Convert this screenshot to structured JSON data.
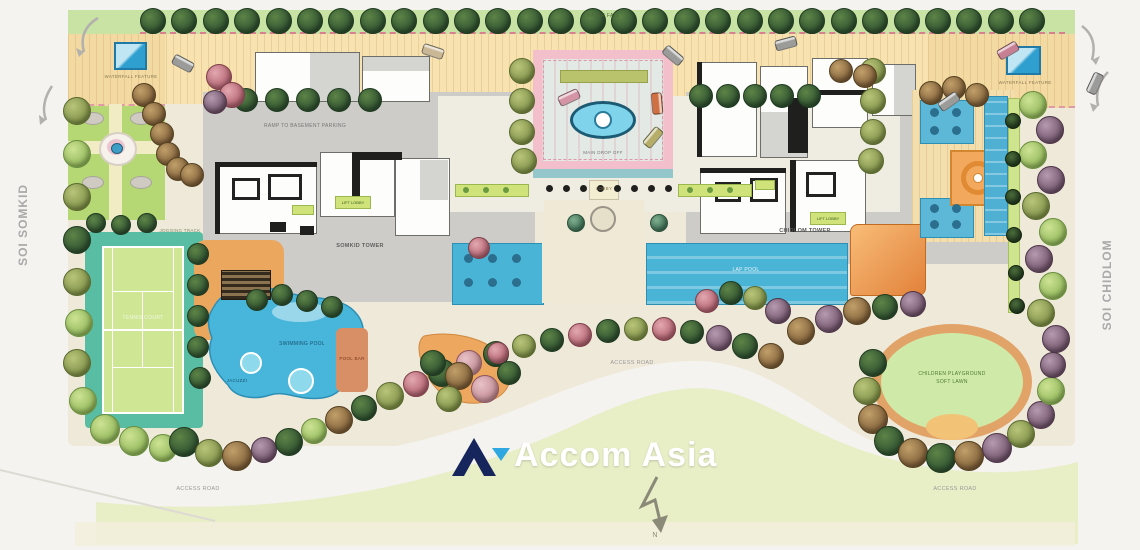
{
  "watermark": {
    "brand": "Accom Asia"
  },
  "compass": {
    "north": "N"
  },
  "roads": {
    "left": "SOI SOMKID",
    "right": "SOI CHIDLOM",
    "access_left": "ACCESS ROAD",
    "access_center": "ACCESS ROAD",
    "access_right": "ACCESS ROAD"
  },
  "site": {
    "top_strip": "WATER FALL",
    "entry_left": "WATERFALL FEATURE",
    "entry_right": "WATERFALL FEATURE",
    "ramp": "RAMP TO BASEMENT PARKING",
    "tower_left": "SOMKID TOWER",
    "tower_right": "CHIDLOM TOWER",
    "drop_off": "MAIN DROP OFF",
    "lobby": "LOBBY",
    "lift_lobby_left": "LIFT LOBBY",
    "lift_lobby_right": "LIFT LOBBY",
    "tennis": "TENNIS COURT",
    "jogging": "JOGGING TRACK",
    "pool": "SWIMMING POOL",
    "jacuzzi": "JACUZZI",
    "pool_bar": "POOL BAR",
    "lap_pool": "LAP POOL",
    "playground_1": "CHILDREN PLAYGROUND",
    "playground_2": "SOFT LAWN"
  },
  "colors": {
    "logo_navy": "#16265c",
    "logo_cyan": "#2fa8e1",
    "pool_blue": "#48b6da",
    "teal_court": "#58bda2",
    "court_lime": "#cfe795",
    "lawn": "#e8eec6",
    "tan_deck": "#f6e0ae",
    "orange_deck": "#eca75f",
    "pink_frame": "#f3bfca",
    "oval_ring": "#e2a368"
  }
}
